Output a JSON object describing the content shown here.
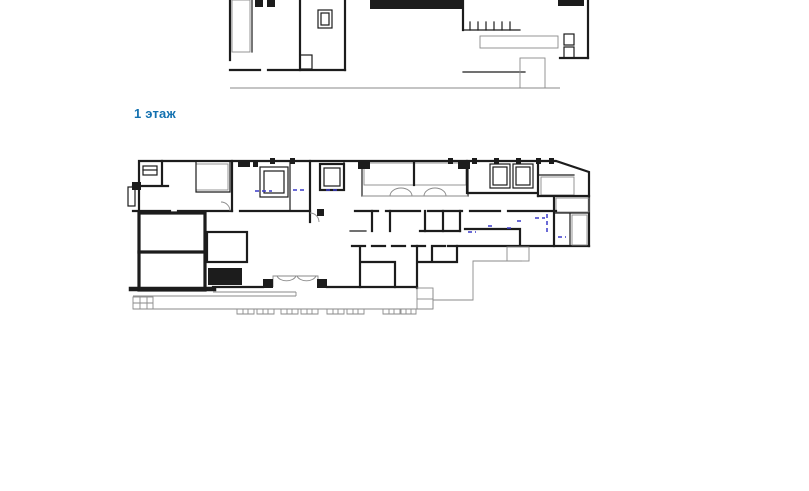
{
  "heading": {
    "text": "1 этаж"
  },
  "theme": {
    "bg": "#ffffff",
    "accent": "#1371b0",
    "wall": "#1c1c1c",
    "thin": "#8a8a8a",
    "hatch": "#5a5a5a",
    "symbol-blue": "#3a3ac8"
  },
  "plan": {
    "kind": "architectural-floor-plan",
    "floor": "1",
    "features": [
      "walls",
      "stairs",
      "elevator-shafts",
      "columns",
      "entrance-porch",
      "terrace",
      "ramp",
      "parking-markers"
    ]
  }
}
